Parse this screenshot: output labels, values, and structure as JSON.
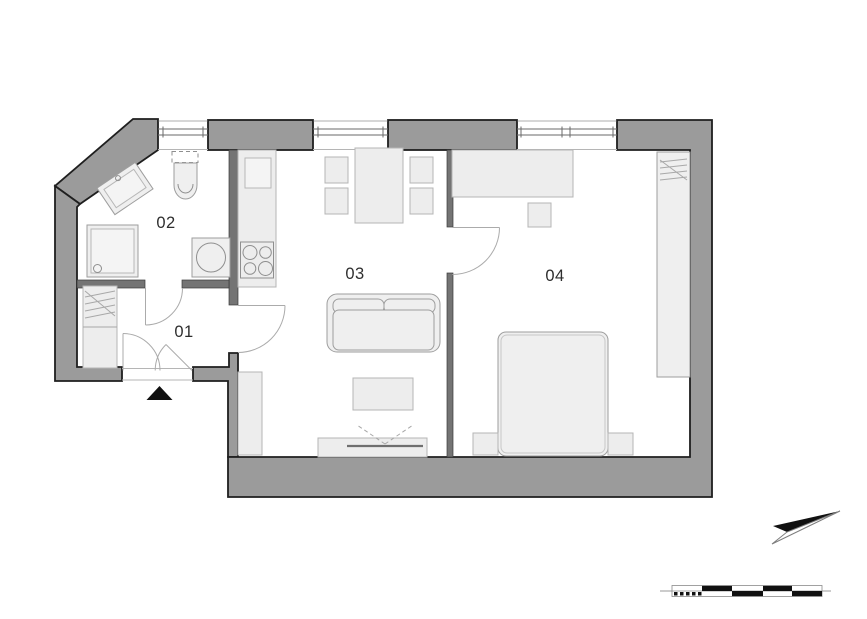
{
  "rooms": [
    {
      "label": "01"
    },
    {
      "label": "02"
    },
    {
      "label": "03"
    },
    {
      "label": "04"
    }
  ],
  "colors": {
    "wall_fill": "#9b9b9b",
    "wall_outline": "#1f1f1f",
    "partition": "#747474",
    "furn_fill": "#efefef",
    "furn_stroke": "#9e9e9e",
    "door_stroke": "#ababab",
    "label": "#2e2e2e",
    "marker_black": "#111111",
    "background": "#ffffff"
  }
}
